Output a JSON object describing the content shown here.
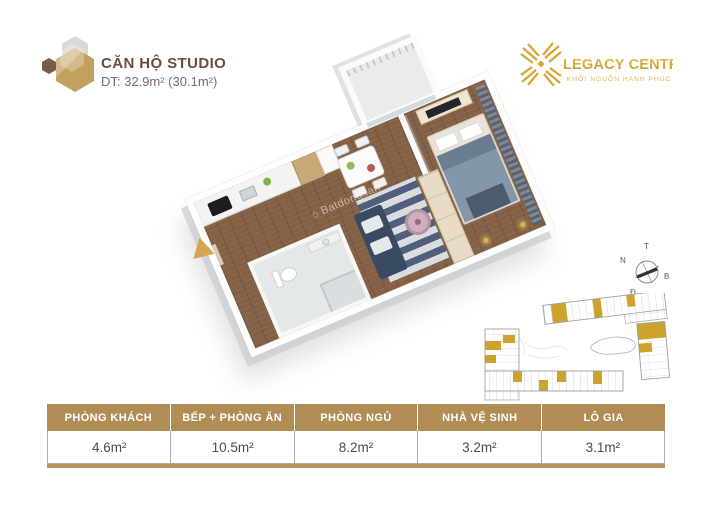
{
  "unit_header": {
    "title": "CĂN HỘ STUDIO",
    "area": "DT: 32.9m² (30.1m²)"
  },
  "brand": {
    "name": "LEGACY CENTRAL",
    "tagline": "KHỞI NGUỒN HẠNH PHÚC",
    "gold": "#D9A331"
  },
  "watermark": {
    "text": "Batdongsan"
  },
  "compass": {
    "top": "T",
    "left": "N",
    "right": "B",
    "bottom": "Đ"
  },
  "colors": {
    "table_header_bg": "#B28C55",
    "hexagon_tan": "#C2A05F",
    "siteplan_highlight": "#CDA32D",
    "entrance_arrow": "#D4A452"
  },
  "area_table": {
    "columns": [
      {
        "label": "PHÒNG KHÁCH",
        "value": "4.6m²"
      },
      {
        "label": "BẾP + PHÒNG ĂN",
        "value": "10.5m²"
      },
      {
        "label": "PHÒNG NGỦ",
        "value": "8.2m²"
      },
      {
        "label": "NHÀ VỆ SINH",
        "value": "3.2m²"
      },
      {
        "label": "LÔ GIA",
        "value": "3.1m²"
      }
    ]
  }
}
